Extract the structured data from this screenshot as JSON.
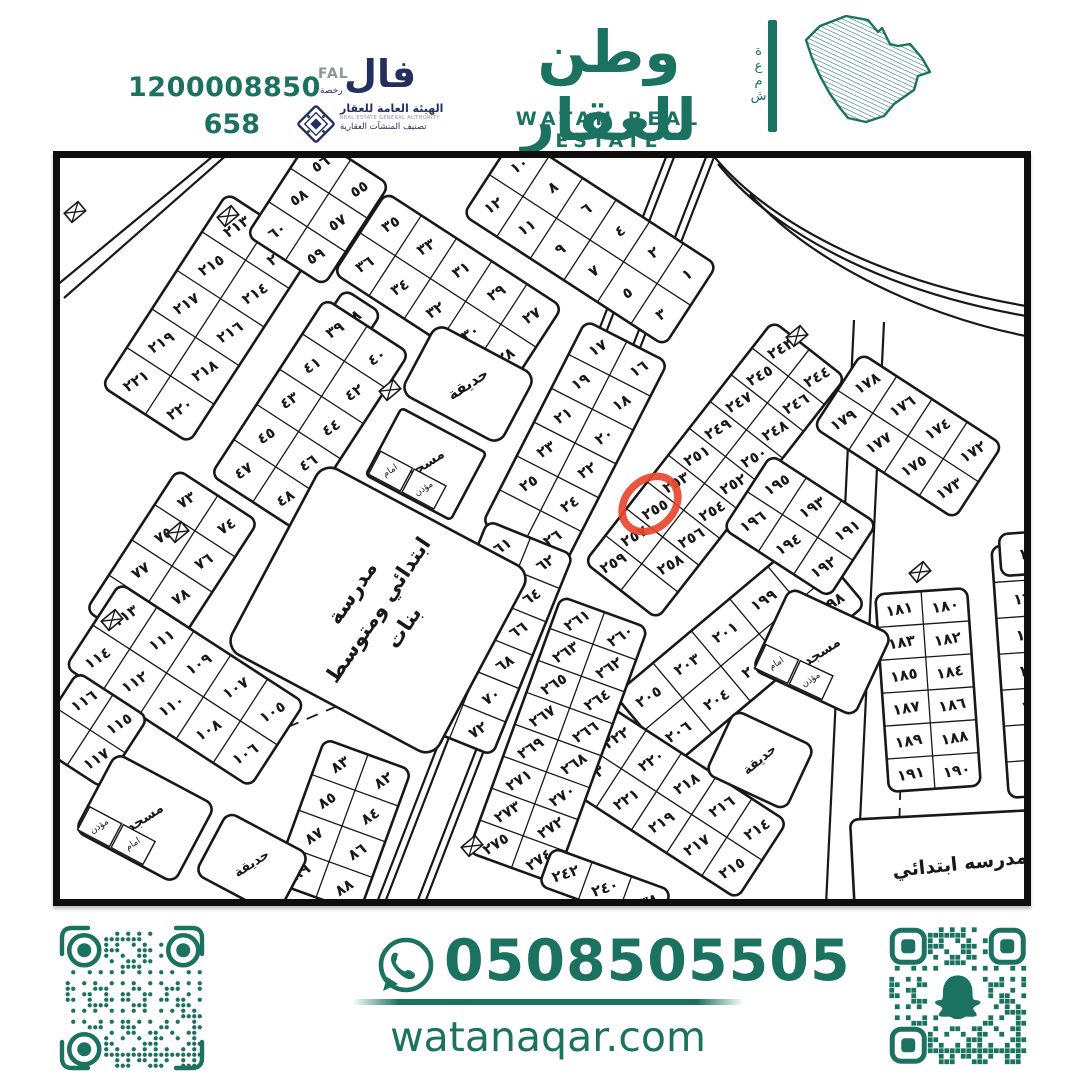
{
  "colors": {
    "brand_green": "#1c7260",
    "navy": "#232f5e",
    "grey": "#8d959c",
    "map_ink": "#181818",
    "highlight_red": "#e8462c"
  },
  "header": {
    "license_number": "1200008850",
    "classification_number": "658",
    "fal_en": "FAL",
    "fal_ar": "فال",
    "fal_sub": "رخصة",
    "authority_title": "الهيئة العامة للعقار",
    "authority_en": "REAL ESTATE GENERAL AUTHORITY",
    "authority_sub": "تصنيف المنشآت العقارية",
    "brand_ar": "وطن للعقار",
    "brand_en": "WATAN REAL ESTATE",
    "brand_vertical": "شمعة"
  },
  "footer": {
    "phone": "0508505505",
    "website": "watanaqar.com"
  },
  "map": {
    "highlight": {
      "label": "٢٥٥",
      "cx": 590,
      "cy": 346,
      "rx": 31,
      "ry": 24,
      "rot": -44
    },
    "blocks": [
      {
        "cx": 148,
        "cy": 160,
        "ang": -57,
        "cw": 46,
        "ch": 52,
        "rows": [
          [
            "٢٢١",
            "٢١٩",
            "٢١٧",
            "٢١٥",
            "٢١٣"
          ],
          [
            "٢٢٠",
            "٢١٨",
            "٢١٦",
            "٢١٤",
            "٢١٢"
          ]
        ]
      },
      {
        "cx": 258,
        "cy": 52,
        "ang": -57,
        "cw": 40,
        "ch": 46,
        "rows": [
          [
            "٦٠",
            "٥٨",
            "٥٦"
          ],
          [
            "٥٩",
            "٥٧",
            "٥٥"
          ]
        ]
      },
      {
        "cx": 530,
        "cy": 82,
        "ang": 33,
        "cw": 40,
        "ch": 48,
        "rows": [
          [
            "١٠",
            "٨",
            "٦",
            "٤",
            "٢",
            "١"
          ],
          [
            "١٢",
            "١١",
            "٩",
            "٧",
            "٥",
            "٣"
          ]
        ]
      },
      {
        "cx": 388,
        "cy": 132,
        "ang": 33,
        "cw": 42,
        "ch": 48,
        "rows": [
          [
            "٣٥",
            "٣٣",
            "٣١",
            "٢٩",
            "٢٧"
          ],
          [
            "٣٦",
            "٣٤",
            "٣٢",
            "٣٠",
            "٢٨"
          ]
        ]
      },
      {
        "cx": 292,
        "cy": 160,
        "ang": -57,
        "cw": 40,
        "ch": 44,
        "rows": [
          [
            "٣٨"
          ]
        ]
      },
      {
        "cx": 250,
        "cy": 256,
        "ang": -57,
        "cw": 42,
        "ch": 50,
        "rows": [
          [
            "٤٧",
            "٤٥",
            "٤٣",
            "٤١",
            "٣٩"
          ],
          [
            "٤٨",
            "٤٦",
            "٤٤",
            "٤٢",
            "٤٠"
          ]
        ]
      },
      {
        "cx": 515,
        "cy": 285,
        "ang": -63,
        "cw": 38,
        "ch": 46,
        "rows": [
          [
            "",
            "٢٥",
            "٢٣",
            "٢١",
            "١٩",
            "١٧"
          ],
          [
            "٢٦",
            "٢٤",
            "٢٢",
            "٢٠",
            "١٨",
            "١٦"
          ]
        ]
      },
      {
        "cx": 430,
        "cy": 480,
        "ang": -68,
        "cw": 36,
        "ch": 46,
        "rows": [
          [
            "٧١",
            "٦٩",
            "٦٧",
            "٦٥",
            "٦٣",
            "٦١"
          ],
          [
            "٧٢",
            "٧٠",
            "٦٨",
            "٦٦",
            "٦٤",
            "٦٢"
          ]
        ]
      },
      {
        "cx": 112,
        "cy": 408,
        "ang": -57,
        "cw": 42,
        "ch": 48,
        "rows": [
          [
            "٧٩",
            "٧٧",
            "٧٥",
            "٧٣"
          ],
          [
            "٨٠",
            "٧٨",
            "٧٦",
            "٧٤"
          ]
        ]
      },
      {
        "cx": 125,
        "cy": 527,
        "ang": 33,
        "cw": 44,
        "ch": 50,
        "rows": [
          [
            "١١٣",
            "١١١",
            "١٠٩",
            "١٠٧",
            "١٠٥"
          ],
          [
            "١١٤",
            "١١٢",
            "١١٠",
            "١٠٨",
            "١٠٦"
          ]
        ]
      },
      {
        "cx": 30,
        "cy": 572,
        "ang": 33,
        "cw": 42,
        "ch": 42,
        "rows": [
          [
            "١١٦",
            "١١٥"
          ],
          [
            "",
            "١١٧"
          ]
        ]
      },
      {
        "cx": 282,
        "cy": 668,
        "ang": -70,
        "cw": 38,
        "ch": 46,
        "rows": [
          [
            "٨٩",
            "٨٧",
            "٨٥",
            "٨٣"
          ],
          [
            "٨٨",
            "٨٦",
            "٨٤",
            "٨٢"
          ]
        ]
      },
      {
        "cx": 655,
        "cy": 312,
        "ang": -52,
        "cw": 34,
        "ch": 46,
        "tr": -30,
        "rows": [
          [
            "٢٥٩",
            "٢٥٧",
            "٢٥٥",
            "٢٥٣",
            "٢٥١",
            "٢٤٩",
            "٢٤٧",
            "٢٤٥",
            "٢٤٣"
          ],
          [
            "",
            "٢٥٨",
            "٢٥٦",
            "٢٥٤",
            "٢٥٢",
            "٢٥٠",
            "٢٤٨",
            "٢٤٦",
            "٢٤٤"
          ]
        ]
      },
      {
        "cx": 680,
        "cy": 492,
        "ang": -40,
        "cw": 50,
        "ch": 46,
        "rows": [
          [
            "٢٠٥",
            "٢٠٣",
            "٢٠١",
            "١٩٩",
            "١٩٧"
          ],
          [
            "٢٠٦",
            "٢٠٤",
            "٢٠٢",
            "٢٠٠",
            "١٩٨"
          ]
        ]
      },
      {
        "cx": 740,
        "cy": 368,
        "ang": 33,
        "cw": 42,
        "ch": 44,
        "rows": [
          [
            "١٩٥",
            "١٩٣",
            "١٩١"
          ],
          [
            "١٩٦",
            "١٩٤",
            "١٩٢"
          ]
        ]
      },
      {
        "cx": 848,
        "cy": 278,
        "ang": 33,
        "cw": 42,
        "ch": 44,
        "rows": [
          [
            "١٧٨",
            "١٧٦",
            "١٧٤",
            "١٧٢"
          ],
          [
            "١٧٩",
            "١٧٧",
            "١٧٥",
            "١٧٣"
          ]
        ]
      },
      {
        "cx": 614,
        "cy": 645,
        "ang": 33,
        "cw": 42,
        "ch": 46,
        "rows": [
          [
            "٢٢٢",
            "٢٢٠",
            "٢١٨",
            "٢١٦",
            "٢١٤"
          ],
          [
            "٢٢٣",
            "٢٢١",
            "٢١٩",
            "٢١٧",
            "٢١٥"
          ]
        ]
      },
      {
        "cx": 498,
        "cy": 582,
        "ang": -70,
        "cw": 34,
        "ch": 46,
        "rows": [
          [
            "٢٧٥",
            "٢٧٣",
            "٢٧١",
            "٢٦٩",
            "٢٦٧",
            "٢٦٥",
            "٢٦٣",
            "٢٦١"
          ],
          [
            "٢٧٤",
            "٢٧٢",
            "٢٧٠",
            "٢٦٨",
            "٢٦٦",
            "٢٦٤",
            "٢٦٢",
            "٢٦٠"
          ]
        ]
      },
      {
        "cx": 545,
        "cy": 730,
        "ang": 20,
        "cw": 42,
        "ch": 40,
        "tr": -18,
        "rows": [
          [
            "٢٤٢",
            "٢٤٠",
            "٢٣٨"
          ]
        ]
      },
      {
        "cx": 868,
        "cy": 532,
        "ang": -4,
        "cw": 46,
        "ch": 33,
        "tr": -10,
        "rows": [
          [
            "١٨١",
            "١٨٠"
          ],
          [
            "١٨٣",
            "١٨٢"
          ],
          [
            "١٨٥",
            "١٨٤"
          ],
          [
            "١٨٧",
            "١٨٦"
          ],
          [
            "١٨٩",
            "١٨٨"
          ],
          [
            "١٩١",
            "١٩٠"
          ]
        ]
      },
      {
        "cx": 972,
        "cy": 512,
        "ang": -4,
        "cw": 64,
        "ch": 36,
        "tr": -8,
        "rows": [
          [
            "١٥٩"
          ],
          [
            "١٦١"
          ],
          [
            "١٦٣"
          ],
          [
            "١٦٥"
          ],
          [
            "١٦٧"
          ],
          [
            "١٦٩"
          ],
          [
            "١٧١"
          ]
        ]
      },
      {
        "cx": 972,
        "cy": 395,
        "ang": -4,
        "cw": 64,
        "ch": 42,
        "tr": -8,
        "rows": [
          [
            "١٥١"
          ]
        ]
      }
    ],
    "areas": [
      {
        "cx": 318,
        "cy": 452,
        "w": 210,
        "h": 235,
        "ang": -62,
        "r": 16,
        "fs": 21,
        "lh": 31,
        "tr": -56,
        "lines": [
          "مدرسة",
          "ابتدائي ومتوسط",
          "بنات"
        ]
      },
      {
        "cx": 408,
        "cy": 226,
        "w": 112,
        "h": 78,
        "ang": 28,
        "r": 12,
        "fs": 15,
        "tr": -33,
        "lines": [
          "حديقة"
        ]
      },
      {
        "cx": 366,
        "cy": 306,
        "w": 96,
        "h": 76,
        "ang": 28,
        "r": 4,
        "fs": 14,
        "tr": -33,
        "lines": [
          "مسجد"
        ],
        "cells": [
          "امام",
          "مؤذن"
        ]
      },
      {
        "cx": 85,
        "cy": 660,
        "w": 112,
        "h": 88,
        "ang": 28,
        "r": 10,
        "fs": 14,
        "tr": -33,
        "lines": [
          "مسجد"
        ],
        "cells": [
          "مؤذن",
          "امام"
        ]
      },
      {
        "cx": 192,
        "cy": 706,
        "w": 92,
        "h": 70,
        "ang": 28,
        "r": 10,
        "fs": 13,
        "tr": -33,
        "lines": [
          "حديقة"
        ]
      },
      {
        "cx": 762,
        "cy": 494,
        "w": 112,
        "h": 90,
        "ang": 25,
        "r": 10,
        "fs": 14,
        "tr": -33,
        "lines": [
          "مسجد"
        ],
        "cells": [
          "امام",
          "مؤذن"
        ]
      },
      {
        "cx": 700,
        "cy": 602,
        "w": 88,
        "h": 70,
        "ang": 25,
        "r": 10,
        "fs": 13,
        "tr": -40,
        "lines": [
          "حديقة"
        ]
      },
      {
        "cx": 900,
        "cy": 706,
        "w": 215,
        "h": 100,
        "ang": -3,
        "r": 8,
        "fs": 19,
        "tr": -6,
        "lines": [
          "مدرسه ابتدائي"
        ]
      }
    ],
    "roads": [
      {
        "d": "M 608,-6 L 316,747"
      },
      {
        "d": "M 616,-6 L 324,747"
      },
      {
        "d": "M 648,-6 L 356,747"
      },
      {
        "d": "M 656,-6 L 364,747"
      },
      {
        "d": "M 652,-4 C 705,62 815,122 966,148"
      },
      {
        "d": "M 658,6 C 712,72 818,132 966,158"
      },
      {
        "d": "M 690,36 C 744,98 854,156 966,178"
      },
      {
        "d": "M 794,162 L 766,747"
      },
      {
        "d": "M 824,164 L 796,747"
      },
      {
        "d": "M -4,128 L 158,-6"
      },
      {
        "d": "M 4,140 L 170,-6"
      },
      {
        "d": "M 150,602 L 452,474",
        "dash": "12 9",
        "w": 1.8
      },
      {
        "d": "M 843,536 L 837,747",
        "dash": "11 8",
        "w": 1.8
      }
    ],
    "kiosks": [
      [
        15,
        54
      ],
      [
        168,
        58
      ],
      [
        330,
        232
      ],
      [
        118,
        374
      ],
      [
        52,
        462
      ],
      [
        412,
        688
      ],
      [
        737,
        178
      ],
      [
        860,
        414
      ]
    ]
  }
}
